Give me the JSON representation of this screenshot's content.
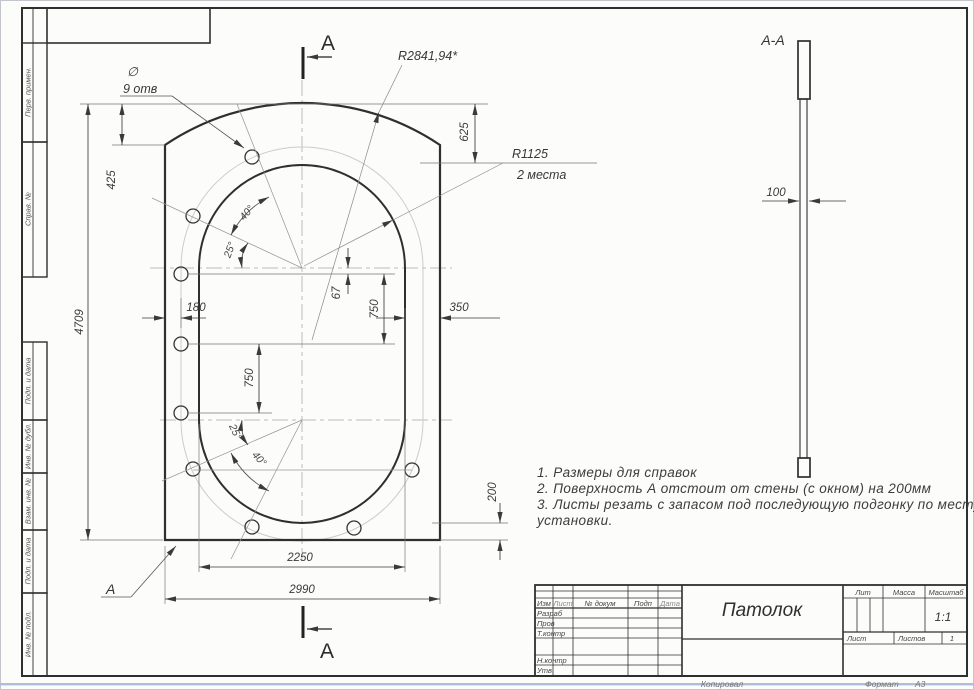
{
  "colors": {
    "paper": "#fcfcfa",
    "line_main": "#2f2f2f",
    "line_thin": "#5a5a5a",
    "line_faint": "#cccccc",
    "centerline": "#bdbdbd",
    "scan_edge_blue": "#aebdd9"
  },
  "margin": {
    "columns": [
      "Перв. примен.",
      "Справ. №",
      "Подп. и дата",
      "Инв. № дубл.",
      "Взам. инв. №",
      "Подп. и дата",
      "Инв. № подл."
    ]
  },
  "view_main": {
    "dims": {
      "overall_width": "2990",
      "opening_width": "2250",
      "overall_height": "4709",
      "top_corner": "425",
      "top_to_opening": "625",
      "edge_to_holes": "180",
      "axis_offset": "67",
      "pitch_upper": "750",
      "pitch_lower": "750",
      "side_margin": "350",
      "bottom_margin": "200"
    },
    "angles": {
      "a40_top": "40°",
      "a25_top": "25°",
      "a25_bottom": "25°",
      "a40_bottom": "40°"
    },
    "callouts": {
      "dia": "∅",
      "holes": "9 отв",
      "r_outer": "R2841,94*",
      "r_inner": "R1125",
      "r_inner_qty": "2 места"
    },
    "section_marks": {
      "top": "А",
      "bottom": "А",
      "surface": "А"
    }
  },
  "view_section": {
    "title": "А-А",
    "thickness": "100"
  },
  "notes": {
    "lines": [
      "1. Размеры для справок",
      "2. Поверхность А отстоит от стены (с окном) на 200мм",
      "3. Листы резать с запасом под последующую подгонку по месту",
      "установки."
    ]
  },
  "title_block": {
    "columns": [
      "Изм",
      "Лист",
      "№ докум",
      "Подп",
      "Дата"
    ],
    "sign_rows": [
      "Разраб",
      "Пров",
      "Т.контр",
      "Н.контр",
      "Утв"
    ],
    "title": "Патолок",
    "lit": "Лит",
    "mass": "Масса",
    "scale_label": "Масштаб",
    "scale": "1:1",
    "sheet": "Лист",
    "sheets": "Листов",
    "sheets_count": "1",
    "copied": "Копировал",
    "format_label": "Формат",
    "format": "А3"
  }
}
